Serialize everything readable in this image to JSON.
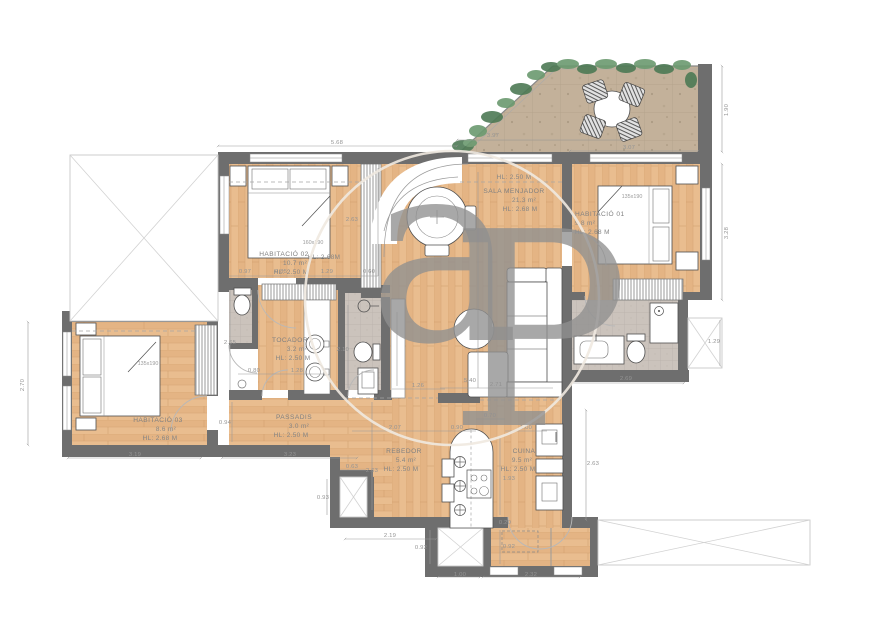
{
  "plan": {
    "rooms": [
      {
        "name": "HABITACIÓ 02",
        "area": "10.7 m²",
        "hl": "HL: 2.50 M",
        "hl2": "HL: 2.68M",
        "bed": "160x190"
      },
      {
        "hl_top": "HL: 2.50 M",
        "name": "SALA MENJADOR",
        "area": "21.3 m²",
        "hl": "HL: 2.68 M"
      },
      {
        "name": "HABITACIÓ 01",
        "area": "9.8 m²",
        "hl": "HL: 2.68 M",
        "bed": "135x190"
      },
      {
        "name": "HABITACIÓ 03",
        "area": "8.6 m²",
        "hl": "HL: 2.68 M",
        "bed": "135x190"
      },
      {
        "name": "TOCADOR",
        "area": "3.2 m²",
        "hl": "HL: 2.50 M"
      },
      {
        "name": "PASSADIS",
        "area": "3.0 m²",
        "hl": "HL: 2.50 M"
      },
      {
        "name": "REBEDOR",
        "area": "5.4 m²",
        "hl": "HL: 2.50 M"
      },
      {
        "name": "CUINA",
        "area": "9.5 m²",
        "hl": "HL: 2.50 M"
      }
    ],
    "dims": [
      {
        "t": "5.68"
      },
      {
        "t": "3.97"
      },
      {
        "t": "3.07"
      },
      {
        "t": "1.90"
      },
      {
        "t": "3.28"
      },
      {
        "t": "2.63"
      },
      {
        "t": "0.97"
      },
      {
        "t": "0.85"
      },
      {
        "t": "1.29"
      },
      {
        "t": "0.60"
      },
      {
        "t": "5.40"
      },
      {
        "t": "2.71"
      },
      {
        "t": "2.70"
      },
      {
        "t": "3.19"
      },
      {
        "t": "3.23"
      },
      {
        "t": "0.94"
      },
      {
        "t": "2.65"
      },
      {
        "t": "0.80"
      },
      {
        "t": "1.28"
      },
      {
        "t": "2.10"
      },
      {
        "t": "1.26"
      },
      {
        "t": "2.69"
      },
      {
        "t": "1.29"
      },
      {
        "t": "2.63"
      },
      {
        "t": "0.63"
      },
      {
        "t": "0.93"
      },
      {
        "t": "2.19"
      },
      {
        "t": "0.92"
      },
      {
        "t": "0.92"
      },
      {
        "t": "0.20"
      },
      {
        "t": "1.93"
      },
      {
        "t": "2.07"
      },
      {
        "t": "0.90"
      },
      {
        "t": "0.70"
      },
      {
        "t": "1.00"
      },
      {
        "t": "1.00"
      },
      {
        "t": "2.32"
      },
      {
        "t": "2.63"
      }
    ],
    "watermark": {
      "text_a": "a",
      "text_p": "P"
    }
  },
  "colors": {
    "wall": "#6e6e6e",
    "wood": "#e8bc8d",
    "tile": "#cbc3bc",
    "terrace_floor": "#c3b19a",
    "greenery": "#4d7a55",
    "greenery_light": "#6b9a70",
    "dim_text": "#949494"
  }
}
